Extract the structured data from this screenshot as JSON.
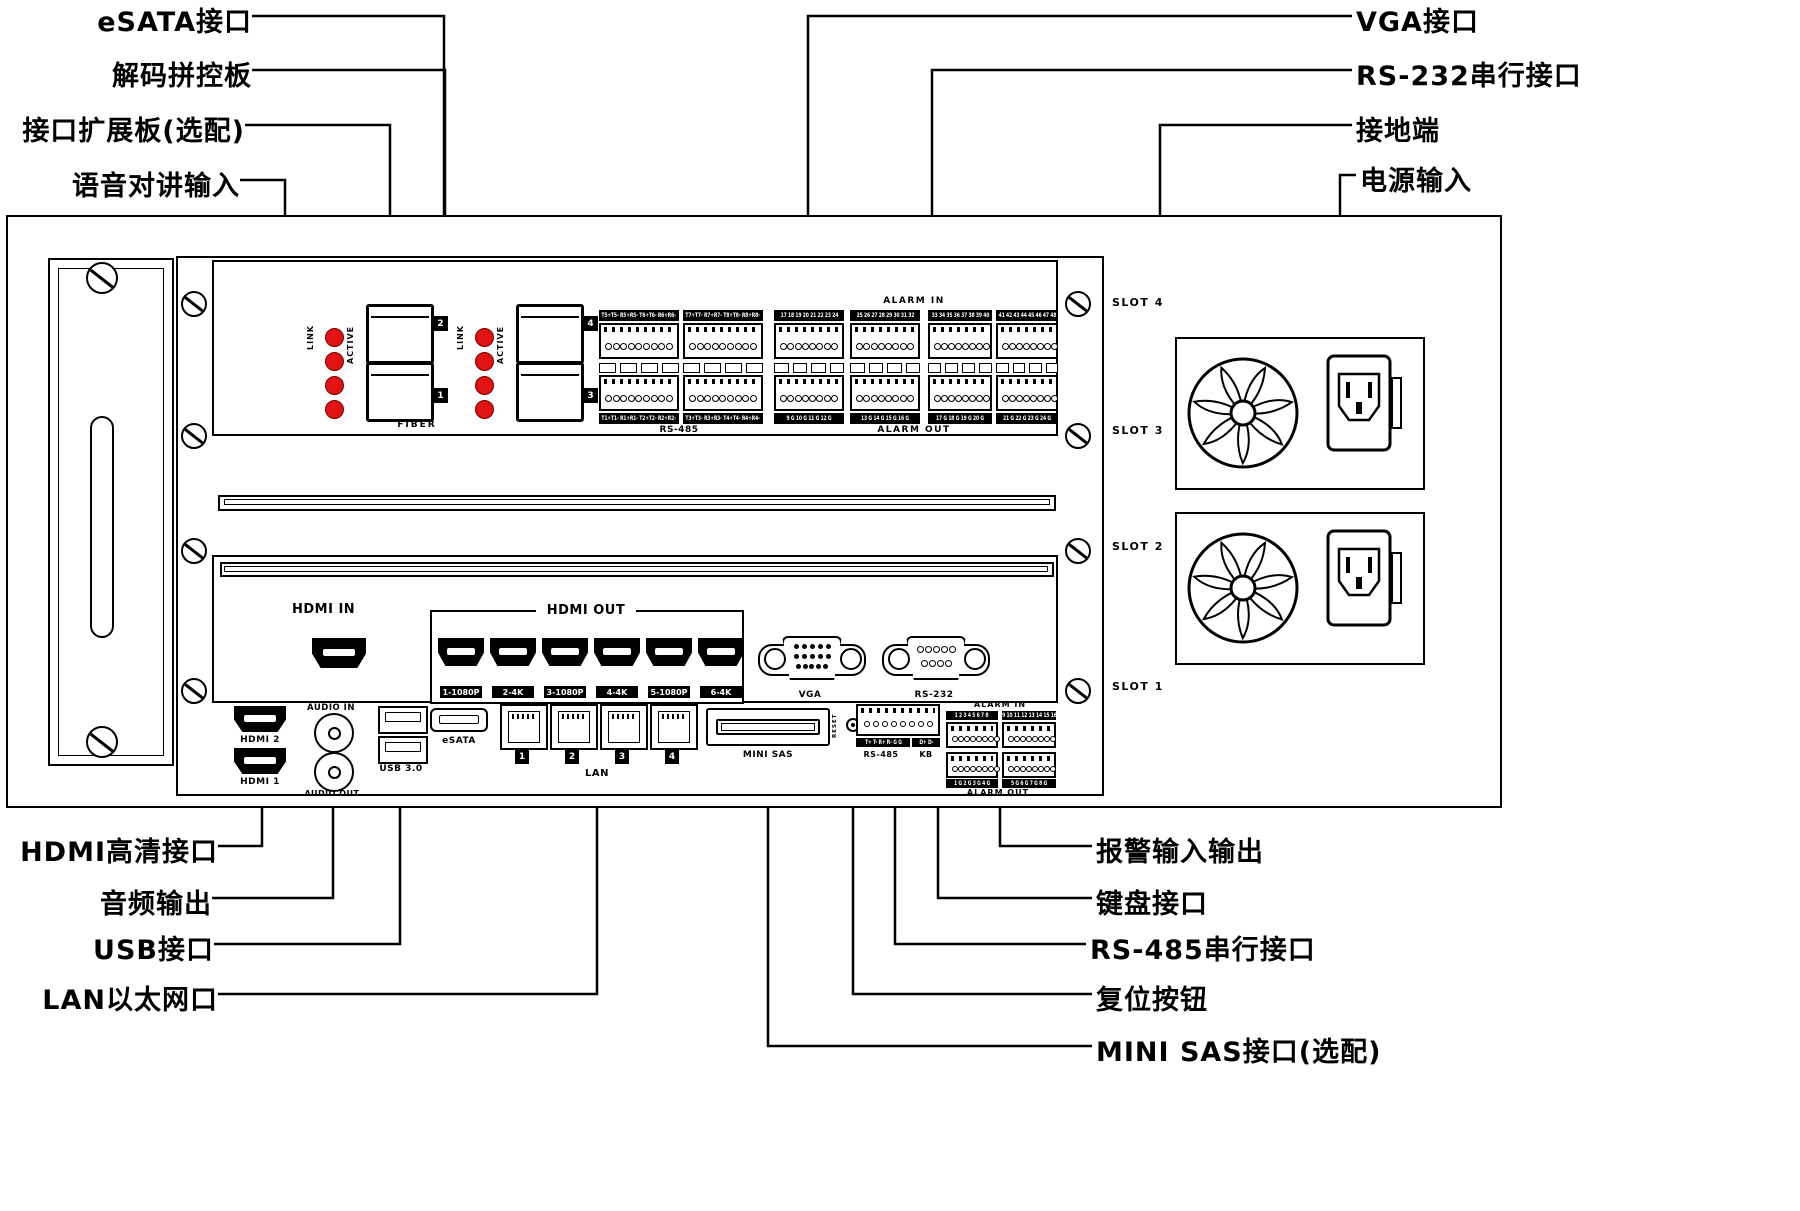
{
  "callouts": {
    "left_top": [
      "eSATA接口",
      "解码拼控板",
      "接口扩展板(选配)",
      "语音对讲输入"
    ],
    "right_top": [
      "VGA接口",
      "RS-232串行接口",
      "接地端",
      "电源输入"
    ],
    "left_bottom": [
      "HDMI高清接口",
      "音频输出",
      "USB接口",
      "LAN以太网口"
    ],
    "right_bottom": [
      "报警输入输出",
      "键盘接口",
      "RS-485串行接口",
      "复位按钮",
      "MINI SAS接口(选配)"
    ]
  },
  "slots": {
    "s4": "SLOT 4",
    "s3": "SLOT 3",
    "s2": "SLOT 2",
    "s1": "SLOT 1"
  },
  "fiber": {
    "link": "LINK",
    "active": "ACTIVE",
    "label": "FIBER",
    "badges": [
      "2",
      "1",
      "4",
      "3"
    ]
  },
  "rs485_card": {
    "top_bars": [
      "T5+T5- R5+R5- T6+T6- R6+R6-",
      "T7+T7- R7+R7- T8+T8- R8+R8-"
    ],
    "bottom_bars": [
      "T1+T1- R1+R1- T2+T2- R2+R2-",
      "T3+T3- R3+R3- T4+T4- R4+R4-"
    ],
    "label": "RS-485"
  },
  "alarm_card": {
    "in_label": "ALARM IN",
    "out_label": "ALARM OUT",
    "in_bars": [
      "17 18 19 20 21 22 23 24",
      "25 26 27 28 29 30 31 32",
      "33 34 35 36 37 38 39 40",
      "41 42 43 44 45 46 47 48"
    ],
    "out_bars": [
      "9 G 10 G 11 G 12 G",
      "13 G 14 G 15 G 16 G",
      "17 G 18 G 19 G 20 G",
      "21 G 22 G 23 G 24 G"
    ]
  },
  "slot2": {
    "hdmi_in": "HDMI IN",
    "hdmi_out": "HDMI OUT",
    "out_labels": [
      "1-1080P",
      "2-4K",
      "3-1080P",
      "4-4K",
      "5-1080P",
      "6-4K"
    ]
  },
  "slot1": {
    "hdmi2": "HDMI 2",
    "hdmi1": "HDMI 1",
    "audio_in": "AUDIO IN",
    "audio_out": "AUDIO OUT",
    "usb": "USB 3.0",
    "lan": "LAN",
    "lan_nums": [
      "1",
      "2",
      "3",
      "4"
    ],
    "esata": "eSATA",
    "vga": "VGA",
    "rs232": "RS-232",
    "reset": "RESET",
    "minisas": "MINI SAS",
    "rs485_bar": "T+ T- R+ R- G G",
    "rs485_label": "RS-485",
    "kb_bar": "D+ D-",
    "kb_label": "KB",
    "alarm_in_label": "ALARM IN",
    "alarm_out_label": "ALARM OUT",
    "alarm_in_bars": [
      "1 2 3 4 5 6 7 8",
      "9 10 11 12 13 14 15 16"
    ],
    "alarm_out_bars": [
      "1 G 2 G 3 G 4 G",
      "5 G 6 G 7 G 8 G"
    ]
  },
  "colors": {
    "led_red": "#e01212",
    "line": "#000000"
  }
}
